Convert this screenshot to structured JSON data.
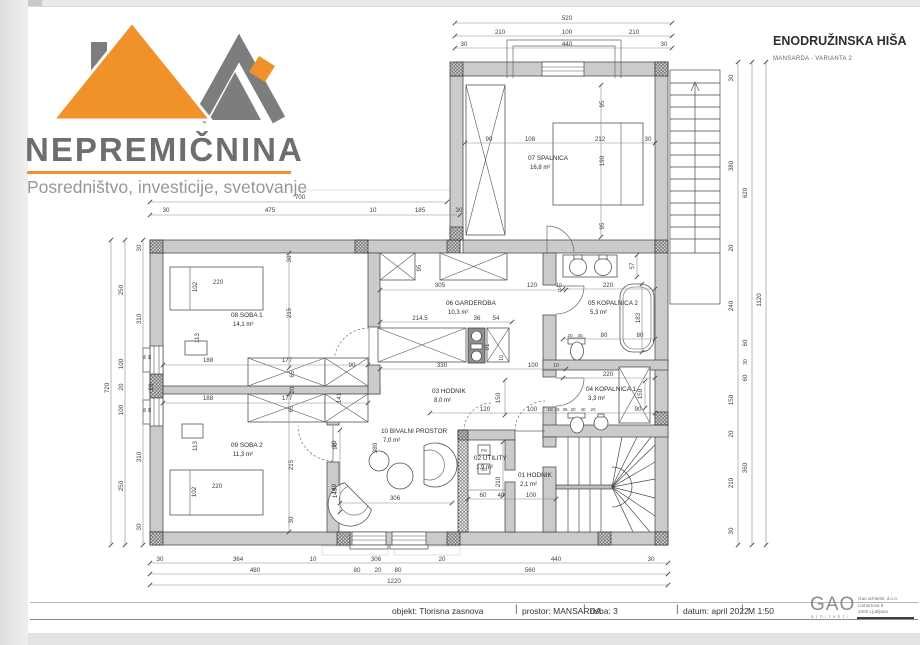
{
  "logo": {
    "brand": "NEPREMIČNINA",
    "tagline": "Posredništvo, investicije, svetovanje",
    "orange": "#f0912a",
    "gray": "#7d7d7d"
  },
  "header": {
    "title": "ENODRUŽINSKA HIŠA",
    "subtitle": "MANSARDA - VARIANTA 2"
  },
  "titleblock": {
    "items": [
      "objekt: Tlorisna zasnova",
      "prostor: MANSARDA",
      "risba:  3",
      "datum: april 2022",
      "M 1:50"
    ],
    "separator": "|"
  },
  "firm": {
    "name": "GAO",
    "role": "arhitekti",
    "address": [
      "Gao arhitekti, d.o.o.",
      "Linhartova 8",
      "1000 Ljubljana"
    ]
  },
  "plan": {
    "scale_note": "M 1:50",
    "rooms": [
      {
        "n": "07 SPALNICA",
        "a": "16,8 m²",
        "x": 528,
        "y": 160
      },
      {
        "n": "08 SOBA 1",
        "a": "14,1 m²",
        "x": 231,
        "y": 317
      },
      {
        "n": "09 SOBA 2",
        "a": "11,3 m²",
        "x": 231,
        "y": 447
      },
      {
        "n": "06 GARDEROBA",
        "a": "10,3 m²",
        "x": 446,
        "y": 305
      },
      {
        "n": "03 HODNIK",
        "a": "8,0 m²",
        "x": 432,
        "y": 393
      },
      {
        "n": "05 KOPALNICA 2",
        "a": "5,3 m²",
        "x": 588,
        "y": 305
      },
      {
        "n": "04 KOPALNICA 1",
        "a": "3,3 m²",
        "x": 586,
        "y": 391
      },
      {
        "n": "10 BIVALNI PROSTOR",
        "a": "7,0 m²",
        "x": 381,
        "y": 433
      },
      {
        "n": "02 UTILITY",
        "a": "1,9 m²",
        "x": 474,
        "y": 460
      },
      {
        "n": "01 HODNIK",
        "a": "2,1 m²",
        "x": 518,
        "y": 477
      }
    ],
    "dims": [
      [
        "520",
        567,
        20,
        0
      ],
      [
        "210",
        500,
        34,
        0
      ],
      [
        "100",
        567,
        34,
        0
      ],
      [
        "210",
        634,
        34,
        0
      ],
      [
        "30",
        464,
        46,
        0
      ],
      [
        "440",
        567,
        46,
        0
      ],
      [
        "30",
        664,
        46,
        0
      ],
      [
        "700",
        300,
        199,
        0
      ],
      [
        "30",
        166,
        212,
        0
      ],
      [
        "475",
        270,
        212,
        0
      ],
      [
        "10",
        373,
        212,
        0
      ],
      [
        "185",
        420,
        212,
        0
      ],
      [
        "30",
        459,
        212,
        0
      ],
      [
        "90",
        489,
        141,
        0
      ],
      [
        "108",
        530,
        141,
        0
      ],
      [
        "212",
        600,
        141,
        0
      ],
      [
        "30",
        648,
        141,
        0
      ],
      [
        "95",
        604,
        104,
        1
      ],
      [
        "190",
        604,
        161,
        1
      ],
      [
        "95",
        604,
        226,
        1
      ],
      [
        "720",
        109,
        388,
        1
      ],
      [
        "250",
        123,
        290,
        1
      ],
      [
        "100",
        123,
        364,
        1
      ],
      [
        "20",
        123,
        387,
        1
      ],
      [
        "100",
        123,
        410,
        1
      ],
      [
        "250",
        123,
        486,
        1
      ],
      [
        "30",
        141,
        248,
        1
      ],
      [
        "310",
        141,
        319,
        1
      ],
      [
        "20",
        153,
        387,
        1
      ],
      [
        "310",
        141,
        457,
        1
      ],
      [
        "30",
        141,
        527,
        1
      ],
      [
        "95",
        146,
        357,
        1,
        4.2
      ],
      [
        "85",
        151,
        357,
        1,
        4.2
      ],
      [
        "95",
        146,
        410,
        1,
        4.2
      ],
      [
        "85",
        151,
        410,
        1,
        4.2
      ],
      [
        "220",
        218,
        284,
        0
      ],
      [
        "102",
        197,
        287,
        1
      ],
      [
        "113",
        199,
        338,
        1
      ],
      [
        "30",
        291,
        259,
        1
      ],
      [
        "215",
        291,
        313,
        1
      ],
      [
        "188",
        208,
        362,
        0
      ],
      [
        "177",
        287,
        362,
        0
      ],
      [
        "65",
        294,
        374,
        1
      ],
      [
        "20",
        294,
        390,
        1
      ],
      [
        "90",
        352,
        367,
        0
      ],
      [
        "141",
        341,
        398,
        1
      ],
      [
        "188",
        208,
        400,
        0
      ],
      [
        "177",
        287,
        400,
        0
      ],
      [
        "65",
        293,
        409,
        1
      ],
      [
        "215",
        293,
        465,
        1
      ],
      [
        "30",
        293,
        520,
        1
      ],
      [
        "113",
        197,
        446,
        1
      ],
      [
        "102",
        196,
        492,
        1
      ],
      [
        "220",
        217,
        488,
        0
      ],
      [
        "90",
        337,
        446,
        1
      ],
      [
        "149",
        337,
        493,
        1
      ],
      [
        "95",
        421,
        268,
        1
      ],
      [
        "305",
        440,
        287,
        0
      ],
      [
        "120",
        532,
        287,
        0
      ],
      [
        "10",
        559,
        287,
        0,
        5
      ],
      [
        "214.5",
        420,
        320,
        0
      ],
      [
        "36",
        477,
        320,
        0
      ],
      [
        "54",
        496,
        320,
        0
      ],
      [
        "81",
        489,
        347,
        1
      ],
      [
        "10",
        503,
        358,
        1,
        5
      ],
      [
        "330",
        442,
        367,
        0
      ],
      [
        "100",
        533,
        367,
        0
      ],
      [
        "10",
        556,
        367,
        0,
        5
      ],
      [
        "150",
        500,
        398,
        1
      ],
      [
        "120",
        485,
        411,
        0
      ],
      [
        "100",
        532,
        411,
        0
      ],
      [
        "10",
        550,
        411,
        0,
        4.6
      ],
      [
        "15",
        557,
        411,
        0,
        4.6
      ],
      [
        "35",
        565,
        411,
        0,
        4.6
      ],
      [
        "20",
        573,
        411,
        0,
        4.6
      ],
      [
        "40",
        583,
        411,
        0,
        4.6
      ],
      [
        "20",
        593,
        411,
        0,
        4.6
      ],
      [
        "90",
        638,
        411,
        0
      ],
      [
        "57",
        634,
        266,
        1
      ],
      [
        "220",
        608,
        287,
        0
      ],
      [
        "10",
        561,
        290,
        1,
        4.6
      ],
      [
        "183",
        640,
        318,
        1
      ],
      [
        "20",
        570,
        337,
        0,
        4.8
      ],
      [
        "40",
        580,
        337,
        0,
        4.8
      ],
      [
        "80",
        604,
        337,
        0
      ],
      [
        "80",
        640,
        337,
        0
      ],
      [
        "220",
        608,
        376,
        0
      ],
      [
        "150",
        642,
        394,
        1
      ],
      [
        "90",
        336,
        444,
        1
      ],
      [
        "380",
        377,
        448,
        1
      ],
      [
        "149",
        336,
        489,
        1
      ],
      [
        "306",
        395,
        500,
        0
      ],
      [
        "210",
        500,
        482,
        1
      ],
      [
        "60",
        483,
        497,
        0
      ],
      [
        "40",
        501,
        497,
        0
      ],
      [
        "100",
        531,
        497,
        0
      ],
      [
        "PS",
        484,
        452,
        0,
        4.4
      ],
      [
        "SS",
        484,
        471,
        0,
        4.4
      ],
      [
        "30",
        733,
        78,
        1
      ],
      [
        "380",
        733,
        166,
        1
      ],
      [
        "20",
        733,
        248,
        1
      ],
      [
        "240",
        733,
        306,
        1
      ],
      [
        "150",
        733,
        400,
        1
      ],
      [
        "20",
        733,
        434,
        1
      ],
      [
        "210",
        733,
        483,
        1
      ],
      [
        "30",
        733,
        531,
        1
      ],
      [
        "620",
        747,
        193,
        1
      ],
      [
        "60",
        747,
        343,
        1
      ],
      [
        "30",
        747,
        362,
        1,
        5
      ],
      [
        "60",
        747,
        378,
        1
      ],
      [
        "360",
        747,
        468,
        1
      ],
      [
        "1120",
        761,
        300,
        1
      ],
      [
        "30",
        160,
        561,
        0
      ],
      [
        "364",
        238,
        561,
        0
      ],
      [
        "10",
        313,
        561,
        0
      ],
      [
        "306",
        376,
        561,
        0
      ],
      [
        "20",
        442,
        561,
        0
      ],
      [
        "440",
        556,
        561,
        0
      ],
      [
        "30",
        651,
        561,
        0
      ],
      [
        "480",
        255,
        572,
        0
      ],
      [
        "80",
        357,
        572,
        0
      ],
      [
        "20",
        378,
        572,
        0
      ],
      [
        "80",
        398,
        572,
        0
      ],
      [
        "560",
        530,
        572,
        0
      ],
      [
        "1220",
        394,
        583,
        0
      ]
    ]
  }
}
